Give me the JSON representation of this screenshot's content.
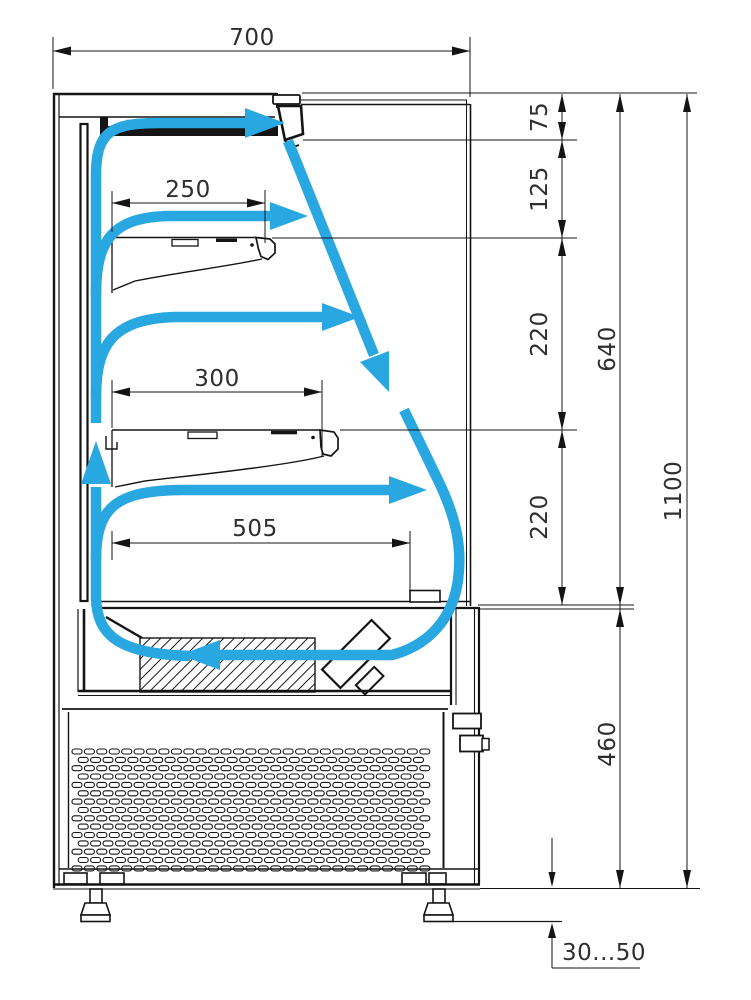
{
  "drawing": {
    "title": "Refrigerated display case — side cross-section with air circulation",
    "units": "mm"
  },
  "colors": {
    "line": "#141414",
    "airflow": "#29a7e0",
    "text": "#2e2e2e",
    "background": "#ffffff"
  },
  "icons": {
    "airflow-arrow": "curved blue arrow showing air circulation",
    "air-curtain-arrow": "dashed diagonal blue arrow (air curtain)",
    "hatch-block": "evaporator block with diagonal hatching",
    "louver-grille": "ventilation grille with slotted louvers"
  },
  "dimensions": {
    "depth_total": "700",
    "shelf_top_depth": "250",
    "shelf_middle_depth": "300",
    "deck_depth": "505",
    "discharge_zone_height": "75",
    "top_shelf_gap": "125",
    "upper_shelf_gap": "220",
    "lower_shelf_gap": "220",
    "opening_height": "640",
    "total_height": "1100",
    "base_height": "460",
    "leg_adjust_range": "30...50"
  }
}
